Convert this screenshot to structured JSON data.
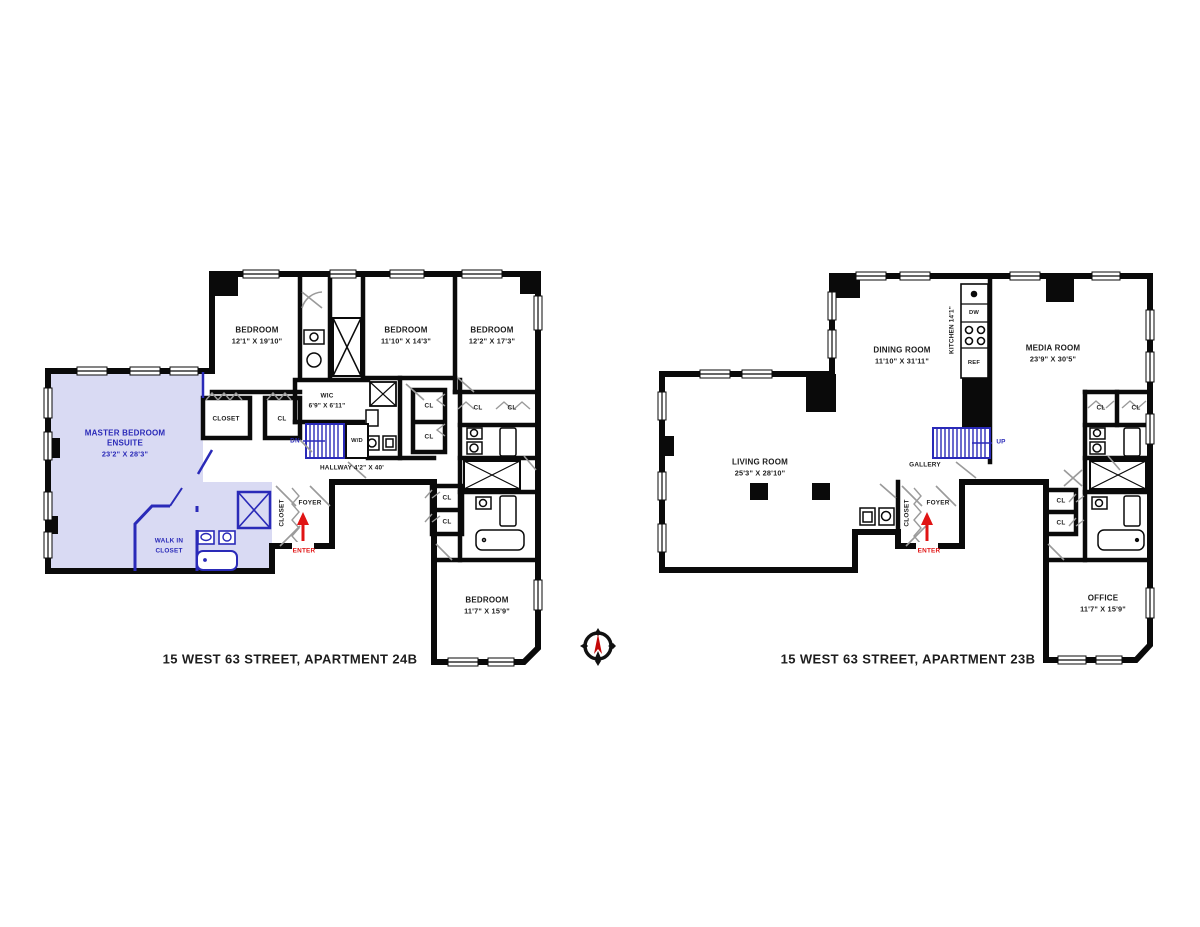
{
  "colors": {
    "wall": "#0a0a0a",
    "master_highlight": "#d9daf3",
    "accent_blue": "#2a2ab8",
    "enter_red": "#e01414",
    "door_gray": "#9a9a9a"
  },
  "plan_24b": {
    "title": "15 WEST 63 STREET, APARTMENT 24B",
    "rooms": {
      "master_bedroom": {
        "line1": "MASTER BEDROOM",
        "line2": "ENSUITE",
        "dims": "23'2\" X 28'3\""
      },
      "bedroom_nw": {
        "line1": "BEDROOM",
        "dims": "12'1\" X 19'10\""
      },
      "bedroom_n": {
        "line1": "BEDROOM",
        "dims": "11'10\" X 14'3\""
      },
      "bedroom_ne": {
        "line1": "BEDROOM",
        "dims": "12'2\" X 17'3\""
      },
      "bedroom_s": {
        "line1": "BEDROOM",
        "dims": "11'7\" X 15'9\""
      },
      "wic": {
        "line1": "WIC",
        "dims": "6'9\" X 6'11\""
      },
      "walk_in_closet": {
        "line1": "WALK IN",
        "line2": "CLOSET"
      },
      "hallway": {
        "label": "HALLWAY 4'2\" X 40'"
      },
      "closet": "CLOSET",
      "foyer": "FOYER",
      "foyer_closet": "CLOSET"
    },
    "markers": {
      "dn": "DN",
      "wd": "W/D",
      "enter": "ENTER",
      "cl": "CL"
    }
  },
  "plan_23b": {
    "title": "15 WEST 63 STREET, APARTMENT 23B",
    "rooms": {
      "living_room": {
        "line1": "LIVING ROOM",
        "dims": "25'3\" X 28'10\""
      },
      "dining_room": {
        "line1": "DINING ROOM",
        "dims": "11'10\" X 31'11\""
      },
      "kitchen": {
        "label": "KITCHEN  14'1\""
      },
      "media_room": {
        "line1": "MEDIA ROOM",
        "dims": "23'9\" X 30'5\""
      },
      "gallery": {
        "label": "GALLERY"
      },
      "office": {
        "line1": "OFFICE",
        "dims": "11'7\" X 15'9\""
      },
      "foyer": "FOYER",
      "foyer_closet": "CLOSET"
    },
    "markers": {
      "up": "UP",
      "enter": "ENTER",
      "cl": "CL",
      "dw": "DW",
      "ref": "REF"
    }
  }
}
